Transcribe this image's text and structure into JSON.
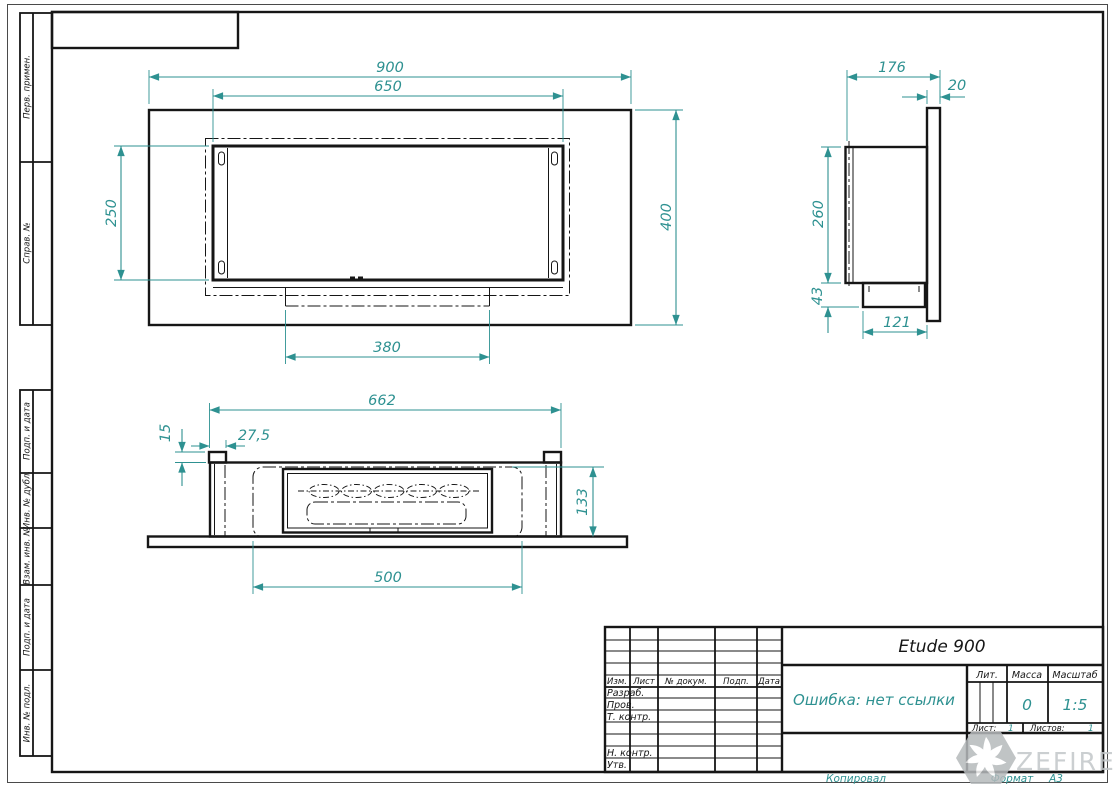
{
  "sheet": {
    "copied_label": "Копировал",
    "format_label": "Формат",
    "format_value": "А3",
    "watermark_text": "ZEFIRE"
  },
  "margin_labels": {
    "perv_primen": "Перв. примен.",
    "sprav_no": "Справ. №",
    "podp_data_top": "Подп. и дата",
    "inv_dubl": "Инв. № дубл.",
    "vzam_inv": "Взам. инв. №",
    "podp_data_bottom": "Подп. и дата",
    "inv_podl": "Инв. № подл."
  },
  "title_block": {
    "designation": "Etude 900",
    "name": "Ошибка: нет ссылки",
    "header_cols": [
      "Изм.",
      "Лист",
      "№ докум.",
      "Подп.",
      "Дата"
    ],
    "row_labels": [
      "Разраб.",
      "Пров.",
      "Т. контр.",
      "Н. контр.",
      "Утв."
    ],
    "lit_label": "Лит.",
    "mass_label": "Масса",
    "mass_value": "0",
    "scale_label": "Масштаб",
    "scale_value": "1:5",
    "sheet_label": "Лист:",
    "sheet_value": "1",
    "sheets_label": "Листов:",
    "sheets_value": "1"
  },
  "views": {
    "front": {
      "width": "900",
      "opening_width": "650",
      "opening_height": "250",
      "height": "400",
      "burner_box_width": "380"
    },
    "side": {
      "depth": "176",
      "panel_thickness": "20",
      "body_height": "260",
      "bottom_box_height": "43",
      "bottom_box_depth": "121"
    },
    "bottom": {
      "body_width": "662",
      "tab_height": "15",
      "tab_offset": "27,5",
      "inner_depth": "133",
      "burner_width": "500"
    }
  },
  "colors": {
    "dimension": "#2e9191",
    "line": "#161616",
    "watermark": "#c3c7c9"
  }
}
